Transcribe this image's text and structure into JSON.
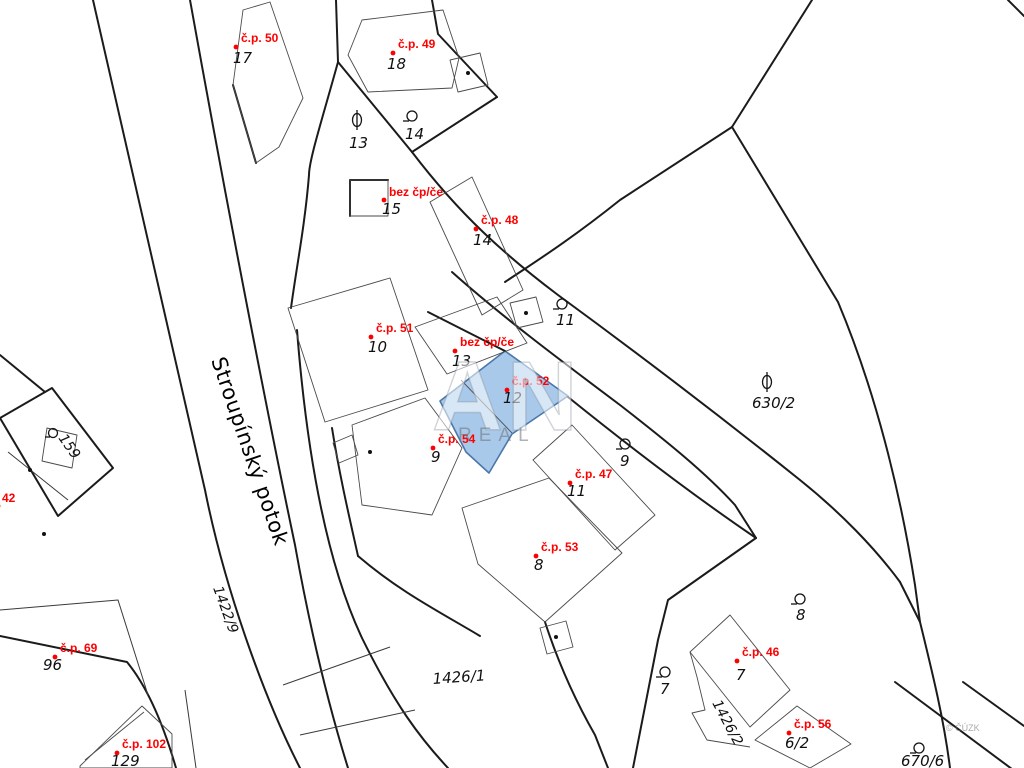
{
  "map": {
    "stream_label": "Stroupínský potok",
    "watermark": {
      "big": "AN",
      "sub": "REAL",
      "copyright": "© ČÚZK"
    },
    "colors": {
      "highlight_fill": "#a9c9ea",
      "highlight_stroke": "#4a77ab",
      "label_red": "#ff0000",
      "line_black": "#1b1b1b"
    }
  },
  "house_labels": [
    {
      "id": "cp-50",
      "text": "č.p. 50",
      "parcel": "17"
    },
    {
      "id": "cp-49",
      "text": "č.p. 49",
      "parcel": "18"
    },
    {
      "id": "bez-15",
      "text": "bez čp/če",
      "parcel": "15"
    },
    {
      "id": "cp-48",
      "text": "č.p. 48",
      "parcel": "14"
    },
    {
      "id": "cp-51",
      "text": "č.p. 51",
      "parcel": "10"
    },
    {
      "id": "bez-13",
      "text": "bez čp/če",
      "parcel": "13"
    },
    {
      "id": "cp-52",
      "text": "č.p. 52",
      "parcel": "12",
      "highlighted": true
    },
    {
      "id": "cp-54",
      "text": "č.p. 54",
      "parcel": "9"
    },
    {
      "id": "cp-47",
      "text": "č.p. 47",
      "parcel": "11"
    },
    {
      "id": "cp-53",
      "text": "č.p. 53",
      "parcel": "8"
    },
    {
      "id": "cp-69",
      "text": "č.p. 69",
      "parcel": "96"
    },
    {
      "id": "cp-102",
      "text": "č.p. 102",
      "parcel": "129"
    },
    {
      "id": "cp-46",
      "text": "č.p. 46",
      "parcel": "7"
    },
    {
      "id": "cp-56",
      "text": "č.p. 56",
      "parcel": "6/2"
    },
    {
      "id": "cp-42",
      "text": "42",
      "parcel": ""
    }
  ],
  "land_parcels": [
    {
      "num": "13",
      "symbol": "orchard"
    },
    {
      "num": "14",
      "symbol": "building-circle"
    },
    {
      "num": "11",
      "symbol": "building-circle"
    },
    {
      "num": "630/2",
      "symbol": "orchard"
    },
    {
      "num": "9",
      "symbol": "building-circle"
    },
    {
      "num": "8",
      "symbol": "building-circle"
    },
    {
      "num": "7",
      "symbol": "building-circle"
    },
    {
      "num": "159",
      "symbol": "building-circle"
    },
    {
      "num": "670/6",
      "symbol": "building-circle"
    }
  ],
  "area_labels": [
    {
      "num": "1422/9"
    },
    {
      "num": "1426/1"
    },
    {
      "num": "1426/2"
    }
  ]
}
